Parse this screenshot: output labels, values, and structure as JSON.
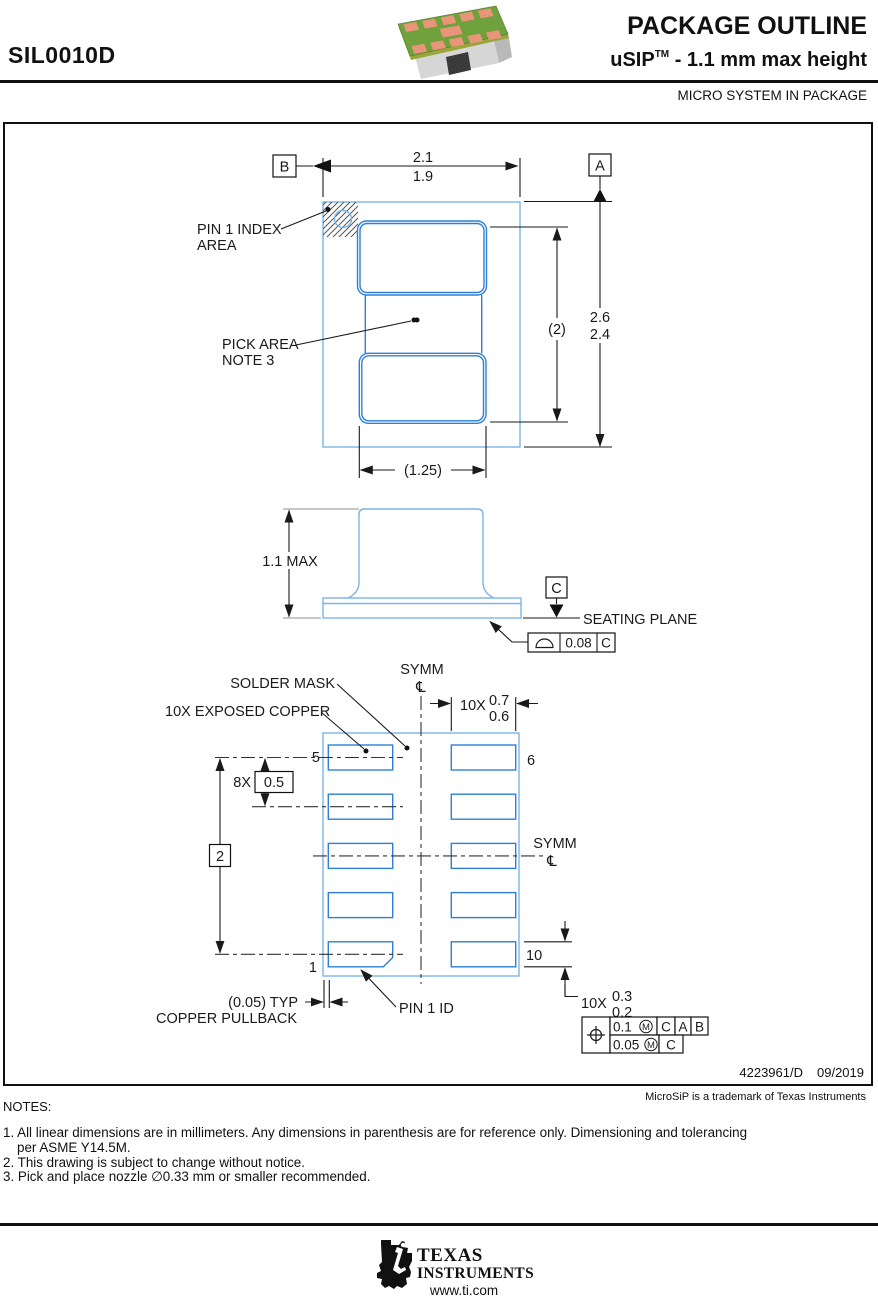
{
  "header": {
    "part_number": "SIL0010D",
    "title": "PACKAGE OUTLINE",
    "subtitle_package": "uSIP",
    "subtitle_tm": "TM",
    "subtitle_rest": " - 1.1 mm max height",
    "subheading": "MICRO SYSTEM IN PACKAGE"
  },
  "top_view": {
    "datum_a": "A",
    "datum_b": "B",
    "dim_width_max": "2.1",
    "dim_width_min": "1.9",
    "dim_height_max": "2.6",
    "dim_height_min": "2.4",
    "dim_ref_height": "(2)",
    "dim_ref_width": "(1.25)",
    "pin1_label_line1": "PIN 1 INDEX",
    "pin1_label_line2": "AREA",
    "pick_area_line1": "PICK AREA",
    "pick_area_line2": "NOTE 3"
  },
  "side_view": {
    "dim_height": "1.1 MAX",
    "datum_c": "C",
    "seating_plane": "SEATING PLANE",
    "flatness_value": "0.08",
    "flatness_datum": "C"
  },
  "bottom_view": {
    "symm_top": "SYMM",
    "symm_right": "SYMM",
    "centerline_symbol": "℄",
    "solder_mask": "SOLDER MASK",
    "exposed_copper": "10X EXPOSED COPPER",
    "pad_width_qty": "10X",
    "pad_width_max": "0.7",
    "pad_width_min": "0.6",
    "pitch_qty": "8X",
    "pitch_value": "0.5",
    "datum_span": "2",
    "pin5": "5",
    "pin6": "6",
    "pin1": "1",
    "pin10": "10",
    "pad_height_qty": "10X",
    "pad_height_max": "0.3",
    "pad_height_min": "0.2",
    "pullback_dim": "(0.05) TYP",
    "pullback_label": "COPPER PULLBACK",
    "pin1_id": "PIN 1 ID",
    "fcf_row1": {
      "tol": "0.1",
      "mod": "M",
      "d1": "C",
      "d2": "A",
      "d3": "B"
    },
    "fcf_row2": {
      "tol": "0.05",
      "mod": "M",
      "d1": "C"
    }
  },
  "footer": {
    "doc_number": "4223961/D",
    "date": "09/2019",
    "trademark": "MicroSiP is a trademark of Texas Instruments",
    "notes_title": "NOTES:",
    "note1a": "1. All linear dimensions are in millimeters. Any dimensions in parenthesis are for reference only. Dimensioning and tolerancing",
    "note1b": "per ASME Y14.5M.",
    "note2": "2. This drawing is subject to change without notice.",
    "note3": "3. Pick and place nozzle ∅0.33 mm or smaller recommended.",
    "logo_line1": "TEXAS",
    "logo_line2": "INSTRUMENTS",
    "website": "www.ti.com"
  },
  "colors": {
    "outline_blue": "#7cb4e8",
    "pad_blue": "#2d7fd9",
    "pcb_green": "#6fa13c",
    "pcb_edge": "#9aa53a",
    "pad_salmon": "#e89579",
    "body_gray": "#d6d6d6",
    "body_gray_dark": "#b9b9b9",
    "line_black": "#1a1a1a"
  }
}
